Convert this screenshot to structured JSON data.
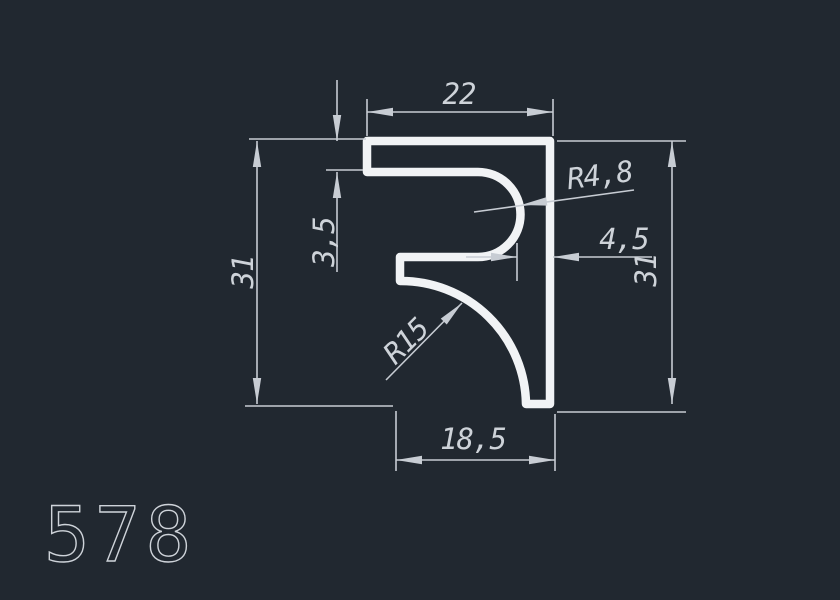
{
  "drawing": {
    "title": "profile-cross-section",
    "part_number": "578",
    "dims": {
      "top_width": "22",
      "flange_thickness": "3,5",
      "height_left": "31",
      "height_right": "31",
      "tip_offset": "4,5",
      "bottom_width": "18,5",
      "slot_radius": "R4,8",
      "fillet_radius": "R15"
    },
    "colors": {
      "background": "#212830",
      "profile": "#f1f3f5",
      "line": "#c7ccd3",
      "text": "#ced3d9"
    }
  }
}
